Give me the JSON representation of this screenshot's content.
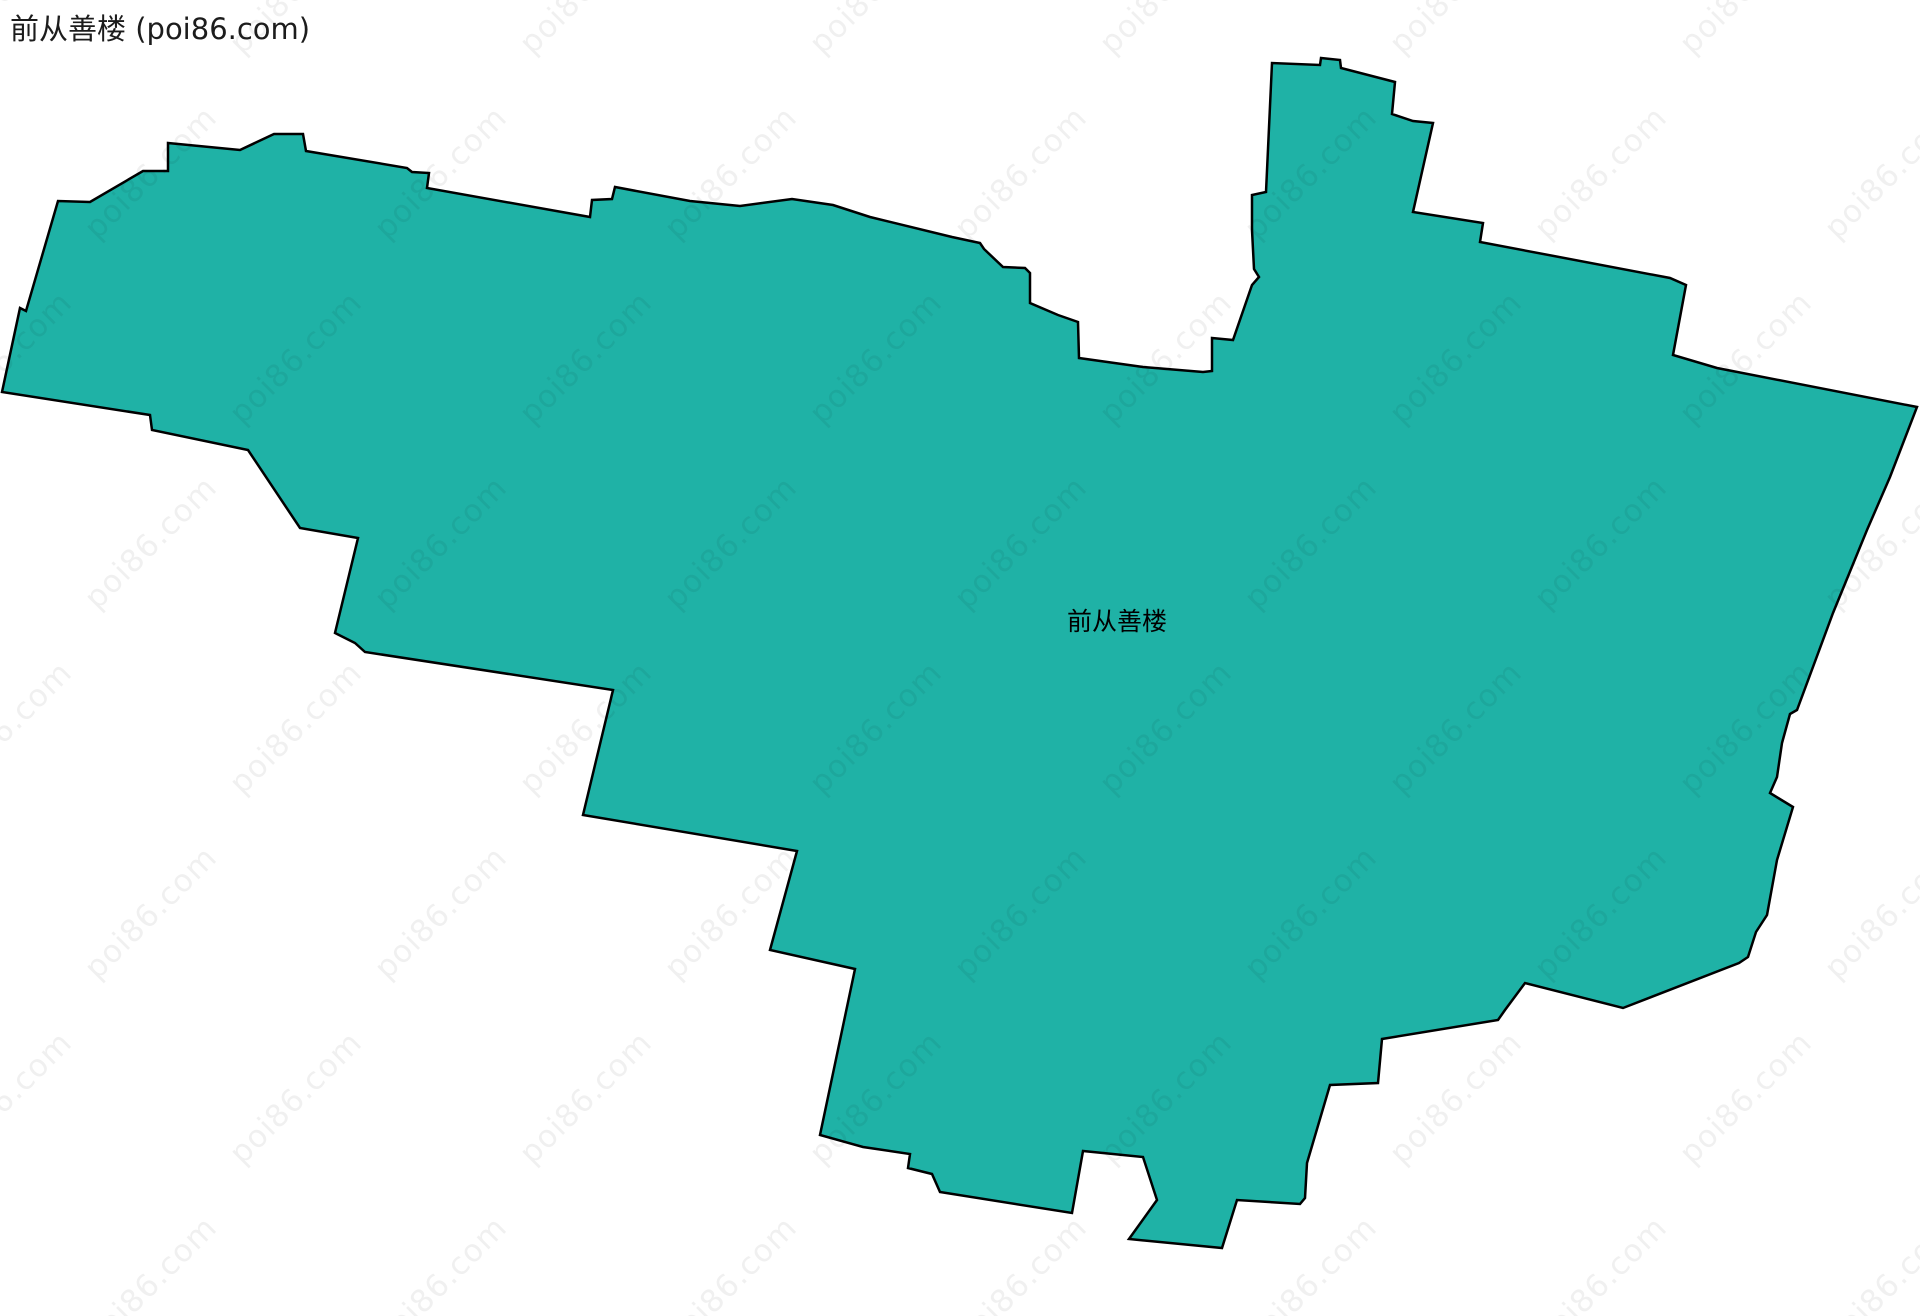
{
  "title": "前从善楼 (poi86.com)",
  "watermark": {
    "text": "poi86.com"
  },
  "map": {
    "region_label": "前从善楼",
    "fill_color": "#1fb2a6",
    "stroke_color": "#000000",
    "stroke_width": 2.5,
    "width": 1920,
    "height": 1316,
    "polygon_points": [
      [
        168,
        143
      ],
      [
        240,
        150
      ],
      [
        274,
        134
      ],
      [
        303,
        134
      ],
      [
        306,
        151
      ],
      [
        407,
        168
      ],
      [
        412,
        172
      ],
      [
        429,
        173
      ],
      [
        427,
        188
      ],
      [
        590,
        217
      ],
      [
        592,
        200
      ],
      [
        612,
        199
      ],
      [
        615,
        187
      ],
      [
        690,
        201
      ],
      [
        740,
        206
      ],
      [
        792,
        199
      ],
      [
        833,
        205
      ],
      [
        870,
        217
      ],
      [
        952,
        237
      ],
      [
        980,
        243
      ],
      [
        984,
        249
      ],
      [
        1003,
        267
      ],
      [
        1025,
        268
      ],
      [
        1030,
        273
      ],
      [
        1030,
        303
      ],
      [
        1058,
        315
      ],
      [
        1078,
        322
      ],
      [
        1079,
        358
      ],
      [
        1143,
        367
      ],
      [
        1203,
        372
      ],
      [
        1212,
        371
      ],
      [
        1212,
        338
      ],
      [
        1233,
        340
      ],
      [
        1252,
        285
      ],
      [
        1259,
        277
      ],
      [
        1254,
        269
      ],
      [
        1252,
        230
      ],
      [
        1252,
        195
      ],
      [
        1266,
        192
      ],
      [
        1272,
        63
      ],
      [
        1320,
        65
      ],
      [
        1321,
        58
      ],
      [
        1340,
        60
      ],
      [
        1341,
        68
      ],
      [
        1395,
        82
      ],
      [
        1392,
        114
      ],
      [
        1413,
        121
      ],
      [
        1433,
        123
      ],
      [
        1413,
        212
      ],
      [
        1483,
        223
      ],
      [
        1480,
        242
      ],
      [
        1670,
        278
      ],
      [
        1686,
        285
      ],
      [
        1673,
        355
      ],
      [
        1717,
        368
      ],
      [
        1917,
        407
      ],
      [
        1890,
        477
      ],
      [
        1867,
        530
      ],
      [
        1833,
        613
      ],
      [
        1797,
        710
      ],
      [
        1790,
        714
      ],
      [
        1782,
        743
      ],
      [
        1777,
        777
      ],
      [
        1770,
        793
      ],
      [
        1793,
        807
      ],
      [
        1777,
        860
      ],
      [
        1767,
        915
      ],
      [
        1756,
        932
      ],
      [
        1748,
        957
      ],
      [
        1739,
        963
      ],
      [
        1623,
        1008
      ],
      [
        1525,
        983
      ],
      [
        1505,
        1010
      ],
      [
        1498,
        1020
      ],
      [
        1382,
        1039
      ],
      [
        1378,
        1083
      ],
      [
        1330,
        1085
      ],
      [
        1307,
        1163
      ],
      [
        1305,
        1198
      ],
      [
        1300,
        1204
      ],
      [
        1237,
        1200
      ],
      [
        1222,
        1248
      ],
      [
        1129,
        1239
      ],
      [
        1157,
        1200
      ],
      [
        1143,
        1157
      ],
      [
        1083,
        1151
      ],
      [
        1072,
        1213
      ],
      [
        940,
        1192
      ],
      [
        932,
        1174
      ],
      [
        908,
        1168
      ],
      [
        910,
        1154
      ],
      [
        863,
        1147
      ],
      [
        820,
        1135
      ],
      [
        855,
        969
      ],
      [
        770,
        950
      ],
      [
        797,
        851
      ],
      [
        583,
        815
      ],
      [
        613,
        690
      ],
      [
        365,
        652
      ],
      [
        355,
        643
      ],
      [
        335,
        633
      ],
      [
        358,
        538
      ],
      [
        300,
        528
      ],
      [
        248,
        450
      ],
      [
        152,
        430
      ],
      [
        150,
        415
      ],
      [
        2,
        392
      ],
      [
        20,
        308
      ],
      [
        26,
        311
      ],
      [
        58,
        201
      ],
      [
        90,
        202
      ],
      [
        143,
        171
      ],
      [
        168,
        171
      ]
    ]
  }
}
